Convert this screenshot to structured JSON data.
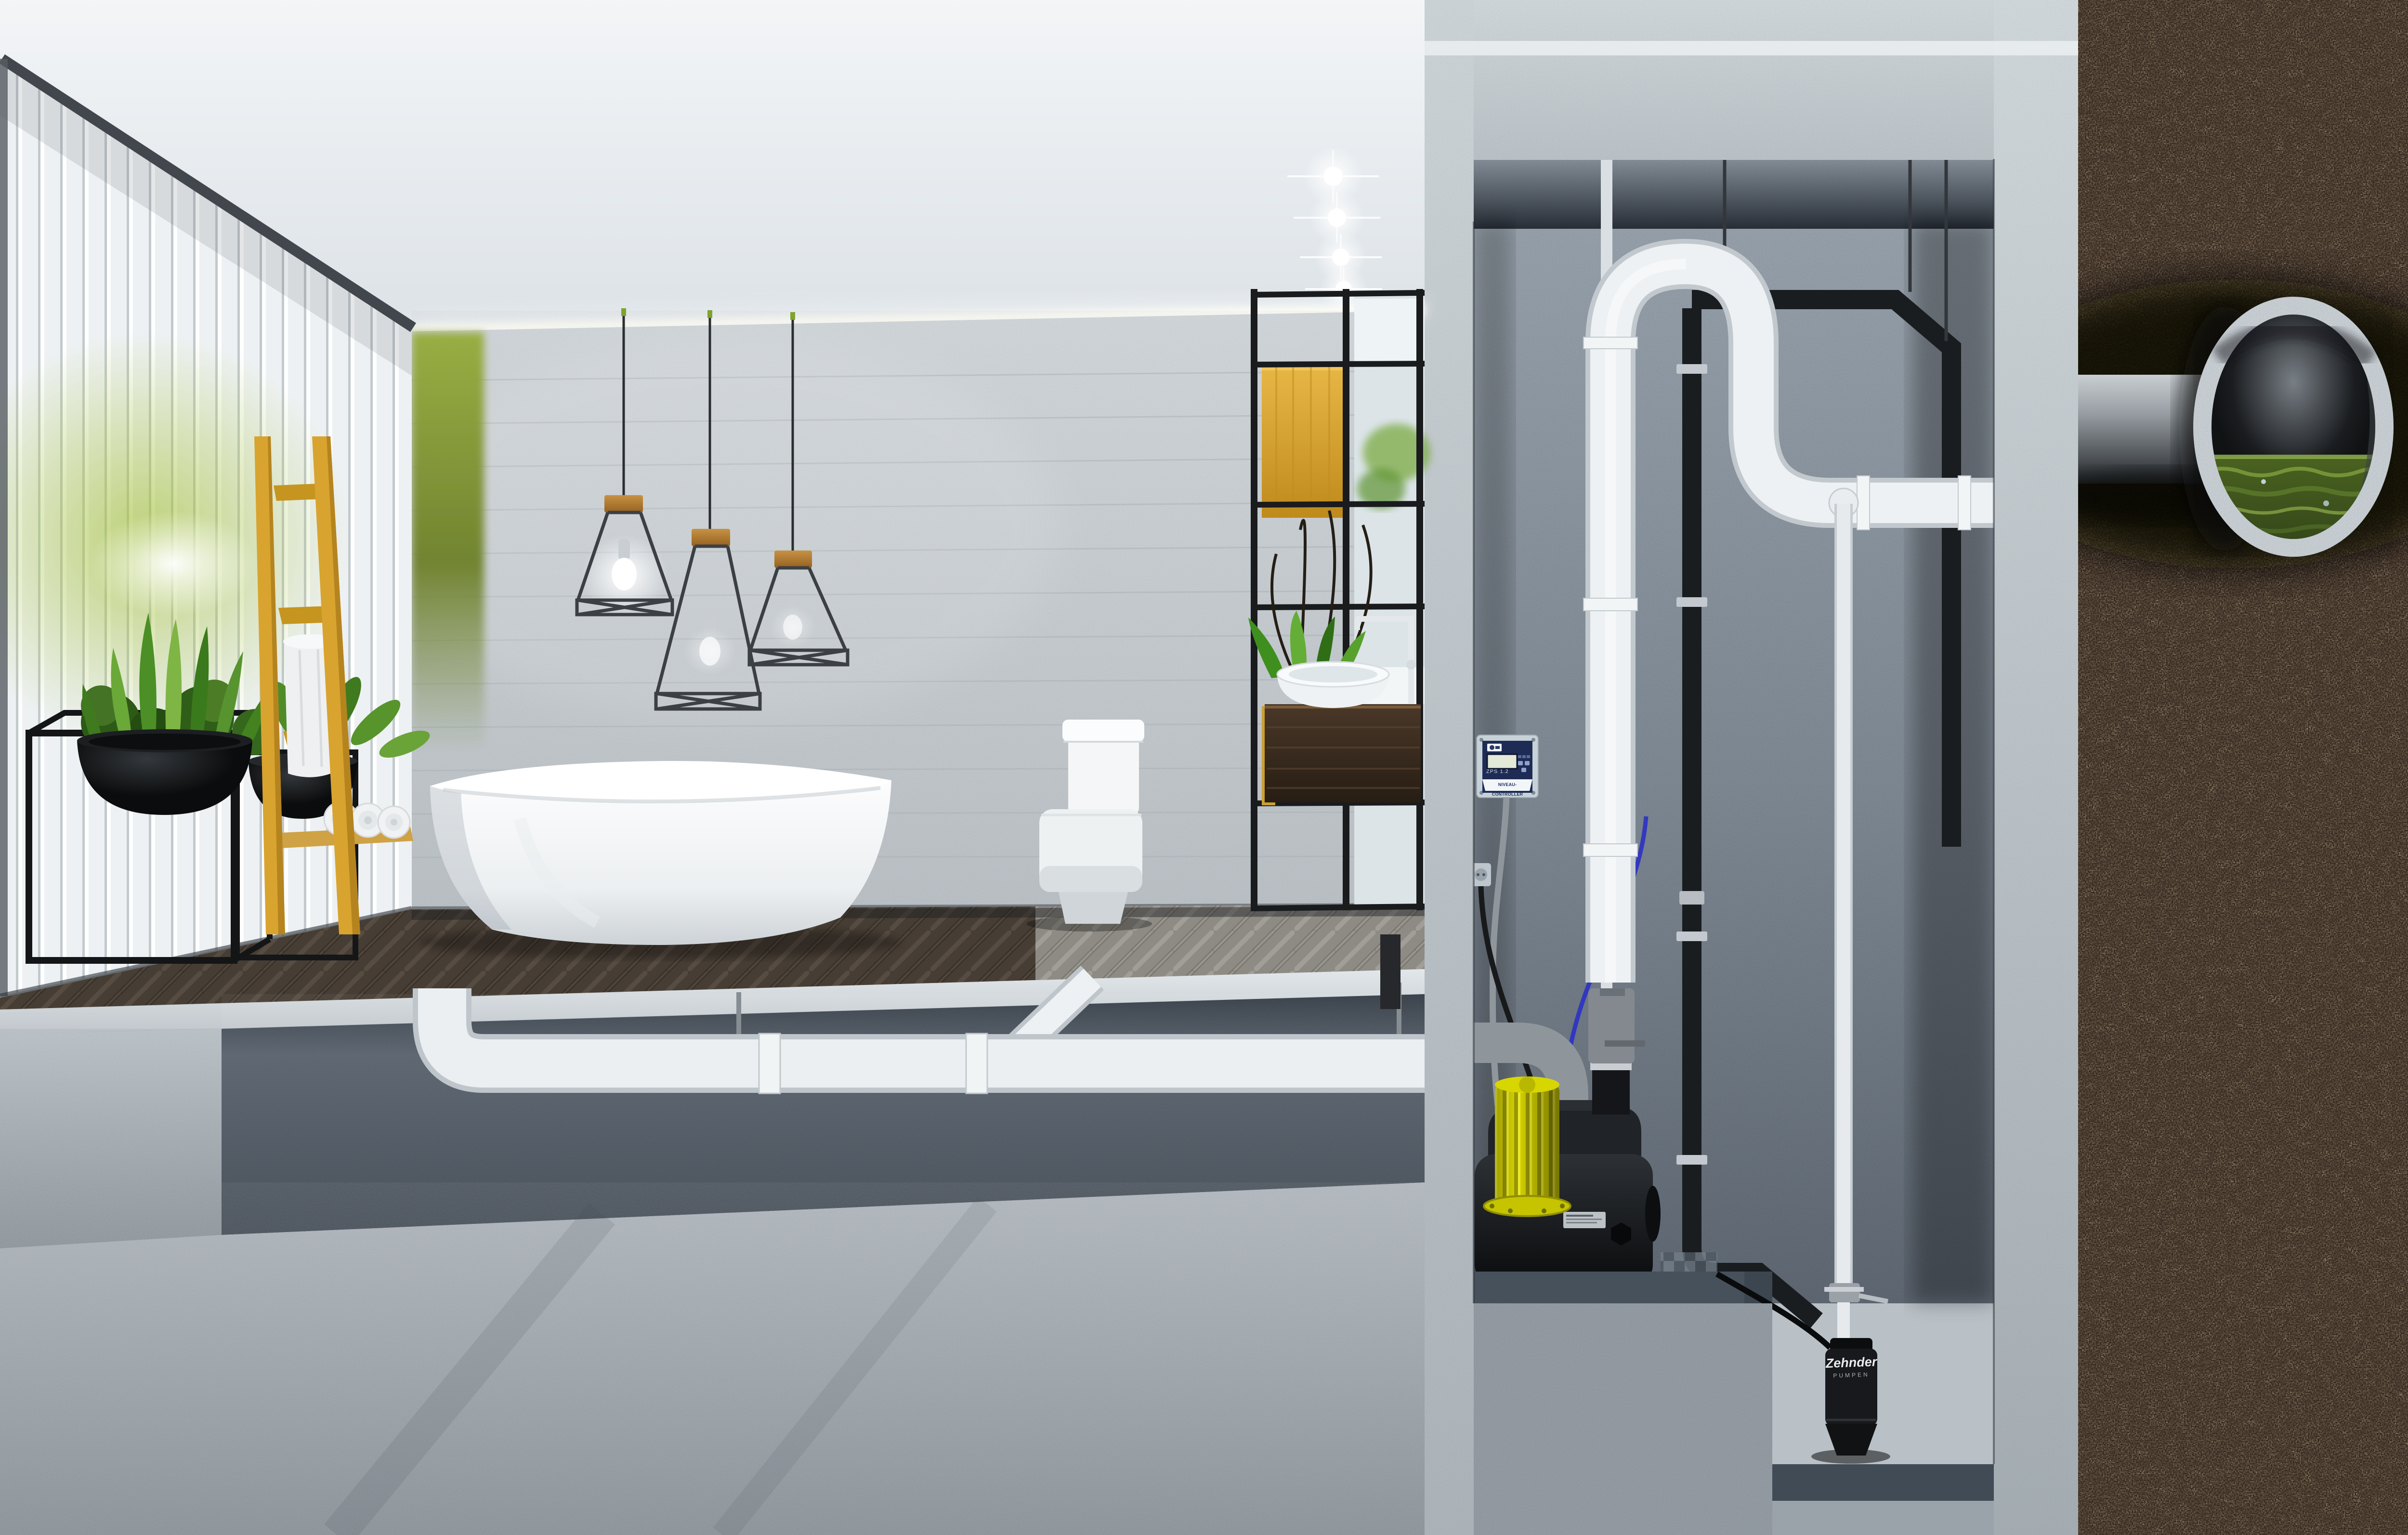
{
  "scene": {
    "type": "photorealistic 3d cutaway render",
    "setting": "modern bathroom above a basement utility shaft with sewage lifting station, connected through soil to a sewer pipe",
    "regions": [
      "bathroom-interior",
      "under-floor-drain-section",
      "utility-shaft",
      "soil-cross-section"
    ],
    "objects": [
      "slatted-glass-wall",
      "green-accent-wall",
      "pendant-cage-lamp",
      "recessed-spotlight",
      "freestanding-bathtub",
      "toilet",
      "vessel-sink-vanity",
      "faucet",
      "shelf-unit",
      "mirror",
      "towel-ladder",
      "rolled-towels",
      "bowl-planter",
      "snake-plant",
      "drain-pipe",
      "lifting-station-pump",
      "pump-motor",
      "check-valve",
      "level-controller",
      "wall-socket",
      "submersible-pump",
      "discharge-pipe-loop",
      "vent-pipe",
      "black-utility-pipe",
      "sewer-pipe",
      "sewage-water"
    ]
  },
  "controller": {
    "title": "NIVEAU- CONTROLLER",
    "model": "ZPS 1.2",
    "logo": "pump-brand-logo",
    "display": "lcd-screen"
  },
  "small_pump": {
    "brand": "Zehnder",
    "line": "PUMPEN"
  },
  "colors": {
    "pump_motor_yellow": "#d6d400",
    "ladder_yellow": "#d8a42f",
    "pipe_white": "#eef1f3",
    "pipe_black": "#1a1d20",
    "controller_navy": "#1e2c55",
    "soil_brown": "#2a2015",
    "sewage_green": "#48601f",
    "concrete_light": "#ccd3d8",
    "shaft_wall_gray": "#7c8793",
    "plant_green": "#4c8f26",
    "accent_wall_green": "#97ac3c"
  }
}
